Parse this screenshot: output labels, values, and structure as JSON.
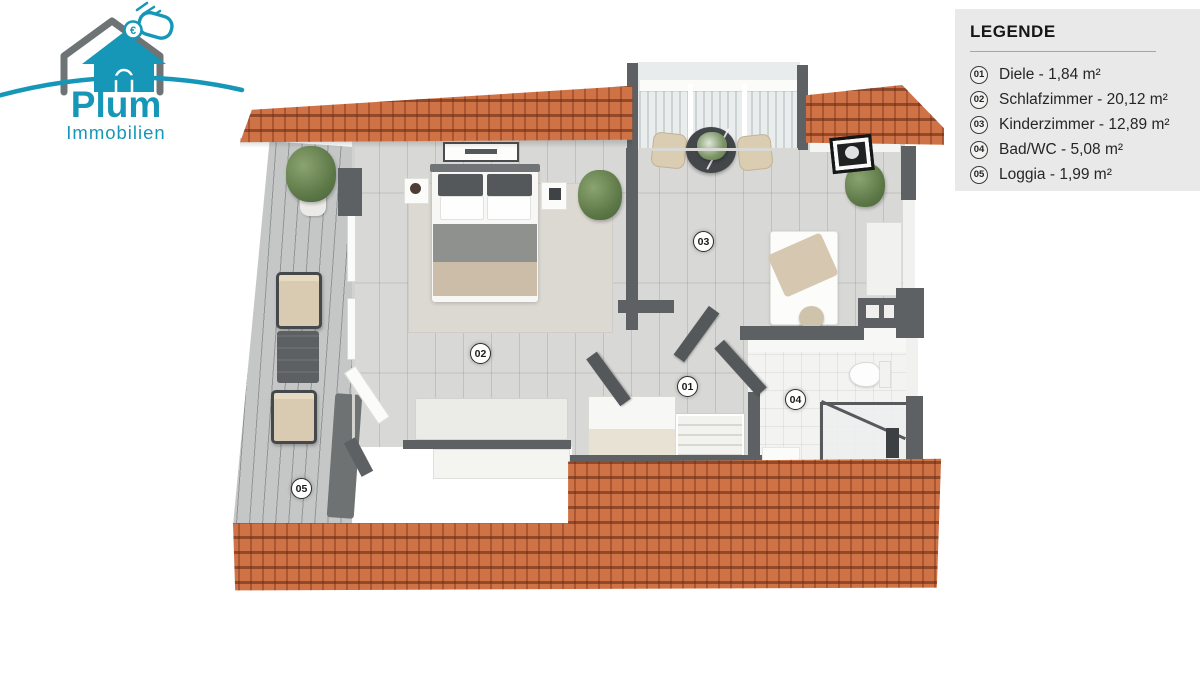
{
  "brand": {
    "name": "Plum",
    "subtitle": "Immobilien",
    "euro": "€",
    "teal": "#1797b8",
    "gray": "#6e7476"
  },
  "legend": {
    "title": "LEGENDE",
    "items": [
      {
        "number": "01",
        "label": "Diele - 1,84 m²"
      },
      {
        "number": "02",
        "label": "Schlafzimmer - 20,12 m²"
      },
      {
        "number": "03",
        "label": "Kinderzimmer - 12,89 m²"
      },
      {
        "number": "04",
        "label": "Bad/WC - 5,08 m²"
      },
      {
        "number": "05",
        "label": "Loggia - 1,99 m²"
      }
    ]
  },
  "floorplan": {
    "markers": [
      {
        "number": "01"
      },
      {
        "number": "02"
      },
      {
        "number": "03"
      },
      {
        "number": "04"
      },
      {
        "number": "05"
      }
    ],
    "colors": {
      "roof_tile": "#cf7347",
      "wall": "#5d6163",
      "wood_floor": "#d8d8d6",
      "deck": "#c6c8c8",
      "bath_tile": "#f3f3f2",
      "legend_bg": "#e9e9e9"
    }
  }
}
